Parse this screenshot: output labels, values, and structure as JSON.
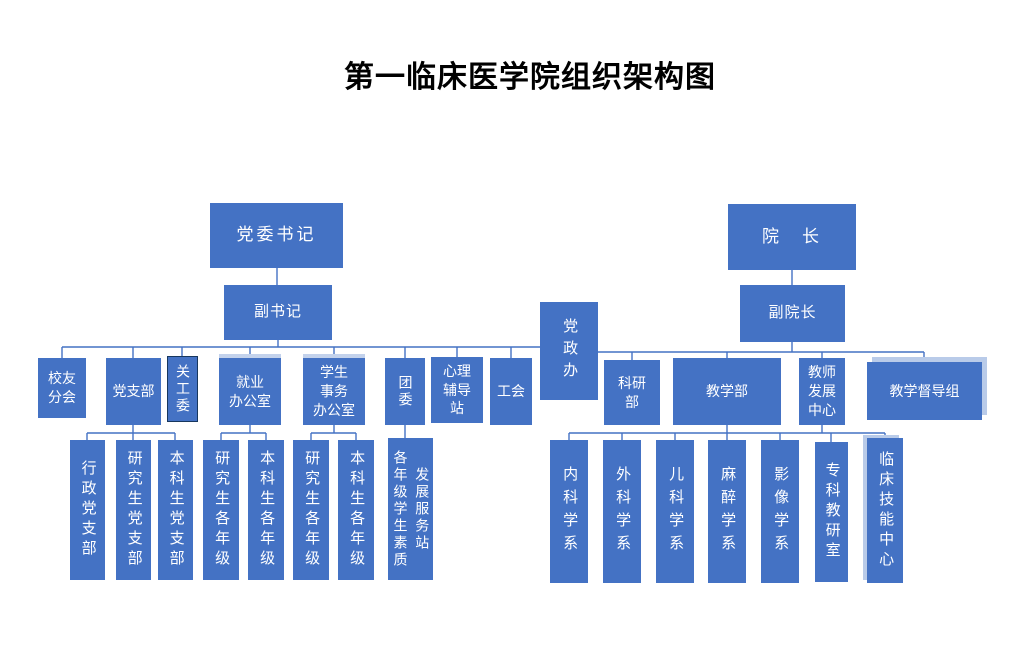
{
  "title": "第一临床医学院组织架构图",
  "colors": {
    "box_fill": "#4472C4",
    "box_text": "#FFFFFF",
    "connector": "#4472C4",
    "title_text": "#000000",
    "background": "#FFFFFF",
    "care_committee_border": "#17375E",
    "highlight_edge": "#B9CBE9"
  },
  "nodes": {
    "party_secretary": "党委书记",
    "dean": "院　长",
    "deputy_secretary": "副书记",
    "vice_dean": "副院长",
    "party_admin_office": "党政办",
    "alumni_branch": "校友\n分会",
    "party_branch": "党支部",
    "care_committee": "关工委",
    "employment_office": "就业\n办公室",
    "student_affairs_office": "学生\n事务\n办公室",
    "youth_league": "团委",
    "counseling_station": "心理\n辅导\n站",
    "labor_union": "工会",
    "research_dept": "科研\n部",
    "teaching_dept": "教学部",
    "teacher_dev_center": "教师\n发展\n中心",
    "supervision_group": "教学督导组",
    "admin_party_branch": "行政党支部",
    "grad_party_branch": "研究生党支部",
    "undergrad_party_branch": "本科生党支部",
    "employment_grad": "研究生各年级",
    "employment_undergrad": "本科生各年级",
    "affairs_grad": "研究生各年级",
    "affairs_undergrad": "本科生各年级",
    "quality_service_station": "各年级学生素质\n发展服务站",
    "internal_medicine": "内科学系",
    "surgery": "外科学系",
    "pediatrics": "儿科学系",
    "anesthesiology": "麻醉学系",
    "imaging": "影像学系",
    "specialty_teaching_office": "专科教研室",
    "clinical_skills_center": "临床技能中心"
  }
}
